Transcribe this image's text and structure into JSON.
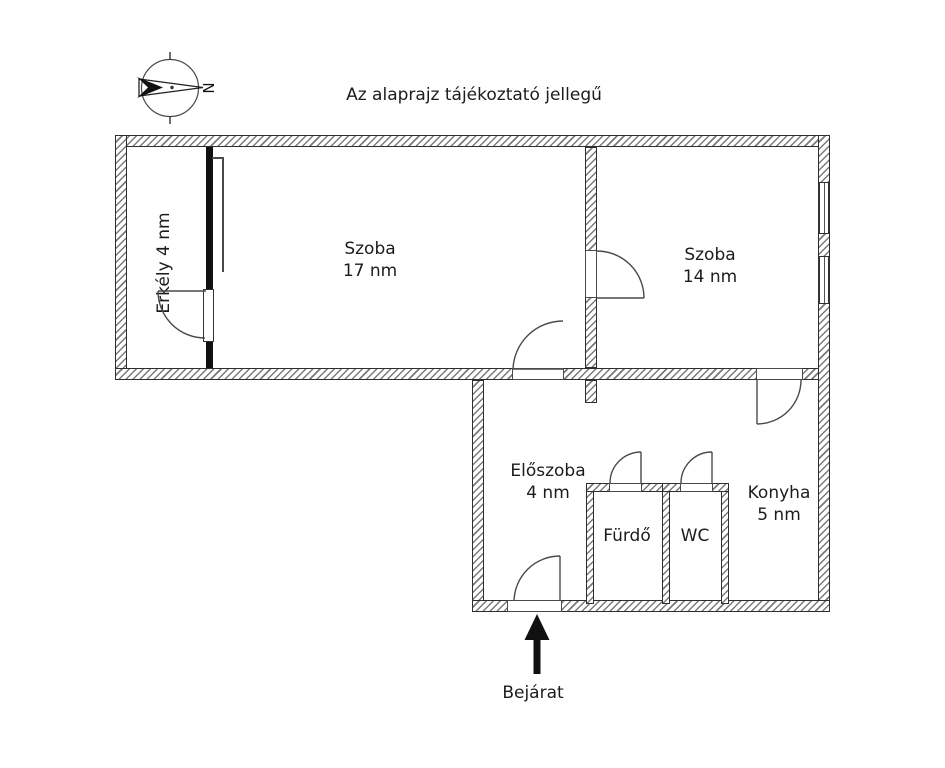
{
  "page": {
    "note": "Az alaprajz tájékoztató jellegű"
  },
  "compass": {
    "north_label": "N"
  },
  "rooms": {
    "erkely": {
      "label": "Erkély 4 nm"
    },
    "szoba17": {
      "name": "Szoba",
      "area": "17 nm"
    },
    "szoba14": {
      "name": "Szoba",
      "area": "14 nm"
    },
    "eloszoba": {
      "name": "Előszoba",
      "area": "4 nm"
    },
    "furdo": {
      "name": "Fürdő"
    },
    "wc": {
      "name": "WC"
    },
    "konyha": {
      "name": "Konyha",
      "area": "5 nm"
    }
  },
  "entrance": {
    "label": "Bejárat"
  },
  "colors": {
    "line": "#333333",
    "solid_wall": "#111111",
    "background": "#ffffff"
  }
}
